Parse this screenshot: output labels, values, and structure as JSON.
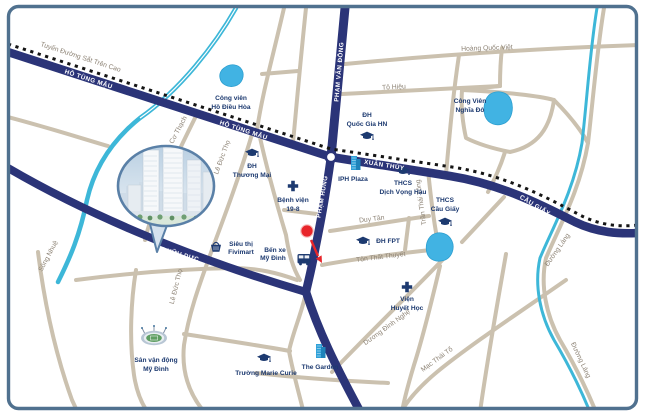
{
  "map_title": "Sơ đồ vị trí dự án khu Mỹ Đình - Cầu Giấy",
  "colors": {
    "border": "#50718f",
    "major_road": "#2b3478",
    "minor_road": "#cbc1af",
    "river": "#3db7d8",
    "lake": "#41b3e3",
    "poi_text": "#1d3a70",
    "street_text": "#8d8375",
    "road_text": "#ffffff",
    "railway": "#151515",
    "marker": "#e8252a",
    "building_icon": "#2da0d8"
  },
  "road_labels": {
    "railway_line": "Tuyến Đường Sắt Trên Cao",
    "ho_tung_mau_west": "HỒ TÙNG MẬU",
    "ho_tung_mau_east": "HỒ TÙNG MẬU",
    "xuan_thuy": "XUÂN THỦY",
    "cau_giay": "CẦU GIẤY",
    "pham_van_dong": "PHẠM VĂN ĐỒNG",
    "pham_hung": "PHẠM HÙNG",
    "tran_huu_duc": "TRẦN HỮU DỰC"
  },
  "street_labels": {
    "hoang_quoc_viet": "Hoàng Quốc Việt",
    "to_hieu": "Tô Hiệu",
    "duy_tan": "Duy Tân",
    "ton_that_thuyet": "Tôn Thất Thuyết",
    "duong_dinh_nghe": "Dương Đình Nghệ",
    "mac_thai_to": "Mạc Thái Tổ",
    "tran_thai_tong": "Trần Thái Tông",
    "nguyen_co_thach": "Nguyễn Cơ Thạch",
    "le_duc_tho_upper": "Lê Đức Thọ",
    "le_duc_tho_lower": "Lê Đức Thọ",
    "song_nhue": "Sông Nhuệ",
    "duong_lang_upper": "Đường Láng",
    "duong_lang_lower": "Đường Láng"
  },
  "pois": {
    "cong_vien_ho_dieu_hoa": {
      "line1": "Công viên",
      "line2": "Hồ Điều Hòa",
      "icon": "lake"
    },
    "cong_vien_nghia_do": {
      "line1": "Công Viên",
      "line2": "Nghĩa Đô",
      "icon": "lake"
    },
    "cong_vien_cau_giay": {
      "line1": "Công Viên",
      "line2": "Cầu Giấy",
      "icon": "lake"
    },
    "dh_quoc_gia": {
      "line1": "ĐH",
      "line2": "Quốc Gia HN",
      "icon": "graduation-cap"
    },
    "dh_thuong_mai": {
      "line1": "ĐH",
      "line2": "Thương Mại",
      "icon": "graduation-cap"
    },
    "thcs_dich_vong_hau": {
      "line1": "THCS",
      "line2": "Dịch Vọng Hậu",
      "icon": "graduation-cap"
    },
    "thcs_cau_giay": {
      "line1": "THCS",
      "line2": "Cầu Giấy",
      "icon": "graduation-cap"
    },
    "dh_fpt": {
      "label": "ĐH FPT",
      "icon": "graduation-cap"
    },
    "truong_marie_curie": {
      "label": "Trường Marie Curie",
      "icon": "graduation-cap"
    },
    "benh_vien_19_8": {
      "line1": "Bệnh viện",
      "line2": "19-8",
      "icon": "medical-cross"
    },
    "vien_huyet_hoc": {
      "line1": "Viện",
      "line2": "Huyết Học",
      "icon": "medical-cross"
    },
    "iph_plaza": {
      "label": "IPH Plaza",
      "icon": "building"
    },
    "the_garden": {
      "label": "The Garden",
      "icon": "building"
    },
    "sieu_thi_fivimart": {
      "line1": "Siêu thị",
      "line2": "Fivimart",
      "icon": "shopping-basket"
    },
    "ben_xe_my_dinh": {
      "line1": "Bến xe",
      "line2": "Mỹ Đình",
      "icon": "bus"
    },
    "san_van_dong_my_dinh": {
      "line1": "Sân vận động",
      "line2": "Mỹ Đình",
      "icon": "stadium"
    }
  }
}
